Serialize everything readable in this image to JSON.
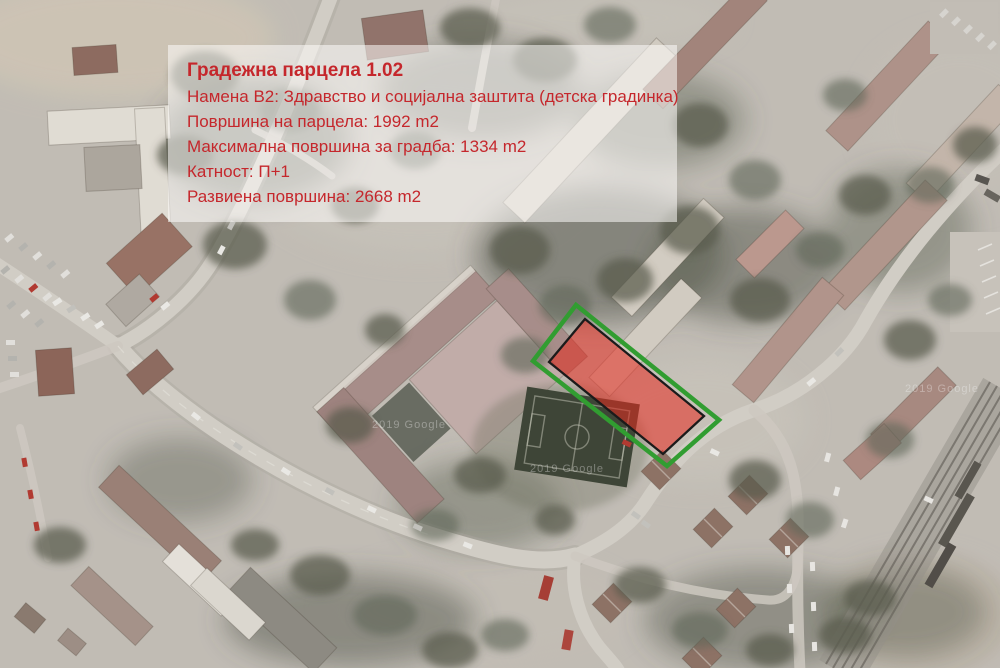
{
  "info_box": {
    "title": "Градежна парцела 1.02",
    "lines": [
      "Намена В2: Здравство и социјална заштита (детска градинка)",
      "Површина на парцела: 1992 m2",
      "Максимална површина за градба: 1334 m2",
      "Катност: П+1",
      "Развиена површина: 2668 m2"
    ],
    "text_color": "#c5272c",
    "background": "rgba(255,255,255,0.55)"
  },
  "parcel_overlay": {
    "boundary_points": "576,305 719,420 667,466 533,361",
    "boundary_color": "#2ca02c",
    "building_points": "585,319 704,416 663,454 549,362",
    "building_fill": "#ee2417",
    "building_fill_opacity": "0.55",
    "building_stroke": "#141414"
  },
  "map": {
    "watermark": "2019 Google"
  }
}
